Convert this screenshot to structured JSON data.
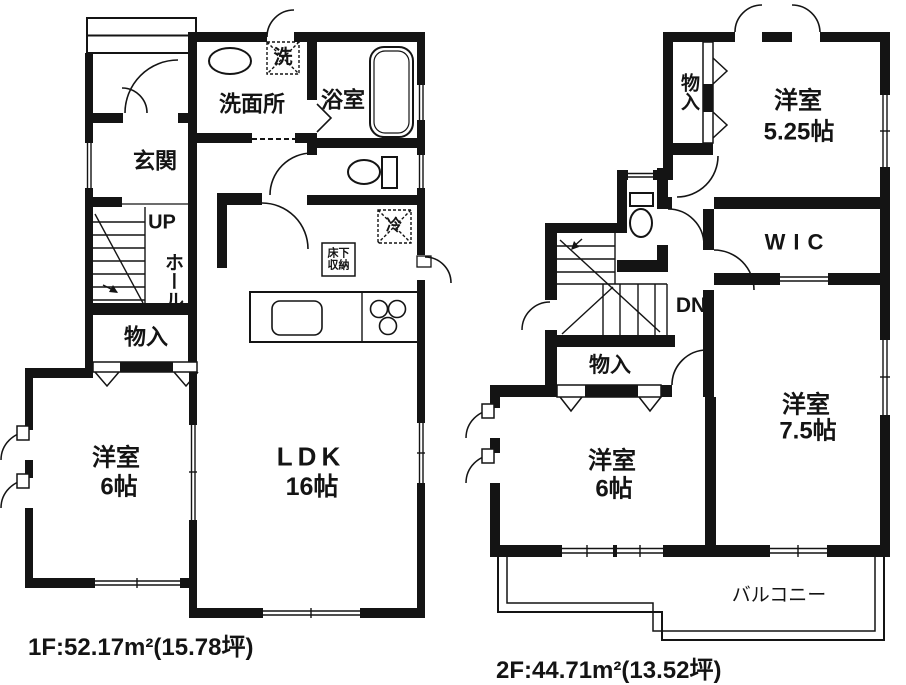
{
  "meta": {
    "type": "floorplan",
    "wall_color": "#141414",
    "bg_color": "#ffffff"
  },
  "floor1": {
    "area_label": "1F:52.17m²(15.78坪)",
    "entrance": "玄関",
    "stairs_up": "UP",
    "hall_vertical": "ホール",
    "storage": "物入",
    "western_room": {
      "name": "洋室",
      "size": "6帖"
    },
    "ldk": {
      "name": "LDK",
      "size": "16帖"
    },
    "washroom": "洗面所",
    "bathroom": "浴室",
    "washer_box": "洗",
    "fridge_box": "冷",
    "underfloor_storage": "床下収納"
  },
  "floor2": {
    "area_label": "2F:44.71m²(13.52坪)",
    "closet_top": "物入",
    "room_525": {
      "name": "洋室",
      "size": "5.25帖"
    },
    "wic": "WIC",
    "stairs_down": "DN",
    "closet_mid": "物入",
    "room_6": {
      "name": "洋室",
      "size": "6帖"
    },
    "room_75": {
      "name": "洋室",
      "size": "7.5帖"
    },
    "balcony": "バルコニー"
  }
}
